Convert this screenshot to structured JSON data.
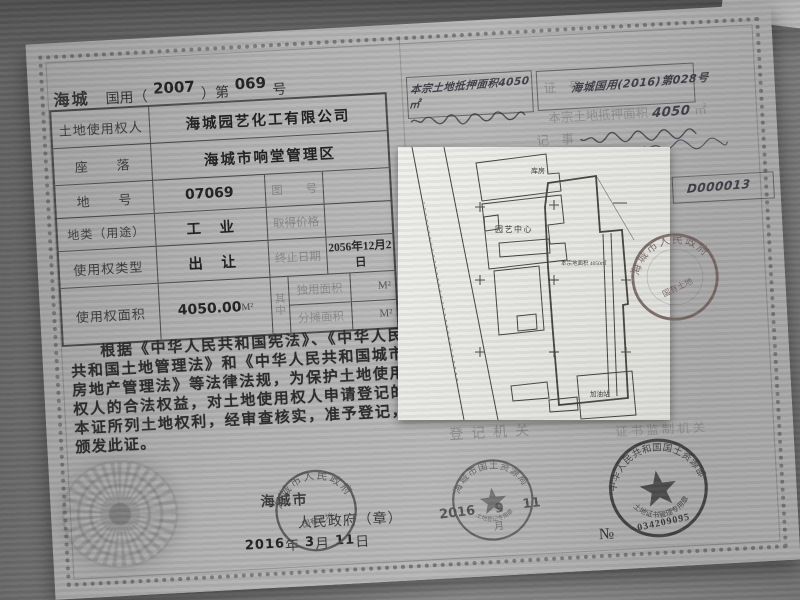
{
  "certificate": {
    "region": "海城",
    "serial_prefix": "国用（",
    "serial_year": "2007",
    "serial_mid": "）第",
    "serial_number": "069",
    "serial_suffix": "号",
    "table": {
      "owner_label": "土地使用权人",
      "owner_value": "海城园艺化工有限公司",
      "location_label": "座　　落",
      "location_value": "海城市响堂管理区",
      "parcel_label": "地　　号",
      "parcel_value": "07069",
      "mapno_label": "图　　号",
      "mapno_value": "",
      "landuse_label": "地类（用途）",
      "landuse_value": "工　业",
      "price_label": "取得价格",
      "price_value": "",
      "righttype_label": "使用权类型",
      "righttype_value": "出　让",
      "expiry_label": "终止日期",
      "expiry_value": "2056年12月2日",
      "area_label": "使用权面积",
      "area_value": "4050.00",
      "area_unit": "M²",
      "qizhong": "其中",
      "sole_label": "独用面积",
      "sole_unit": "M²",
      "shared_label": "分摊面积",
      "shared_unit": "M²"
    },
    "decree": "根据《中华人民共和国宪法》、《中华人民共和国土地管理法》和《中华人民共和国城市房地产管理法》等法律法规，为保护土地使用权人的合法权益，对土地使用权人申请登记的本证所列土地权利，经审查核实，准予登记，颁发此证。",
    "issuer_city": "海城市",
    "issuer_gov": "人民政府（章）",
    "issue_year": "2016",
    "year_label": "年",
    "issue_month": "3",
    "month_label": "月",
    "issue_day": "11",
    "day_label": "日"
  },
  "right_page": {
    "note_mortgage_area": "本宗土地抵押面积4050㎡",
    "certno_label": "证　号",
    "certno_value": "海城国用(2016)第028号",
    "mortgage_label": "本宗土地抵押面积",
    "mortgage_value": "4050",
    "mortgage_unit": "㎡",
    "memo_label": "记　事",
    "doc_number": "D000013",
    "registry_label": "登记机关",
    "supervisor_label": "证书监制机关"
  },
  "map": {
    "labels": {
      "warehouse": "库房",
      "center": "园艺中心",
      "area_note": "本宗地面积 4050㎡",
      "station": "加油站"
    }
  },
  "stamps": {
    "gov": {
      "arc": "海城市人民政府",
      "inner": "国有土地"
    },
    "bureau": {
      "arc": "海城市国土资源局",
      "bottom": "土地登记专用章",
      "date_year": "2016",
      "date_month": "9",
      "date_day": "11",
      "month_label": "月"
    },
    "ministry": {
      "arc": "中华人民共和国国土资源部",
      "bottom": "土地证书管理专用章",
      "no_label": "№",
      "number": "034209095"
    },
    "map_seal": {
      "arc": "海城市人民政府",
      "inner": "国有土地"
    }
  }
}
